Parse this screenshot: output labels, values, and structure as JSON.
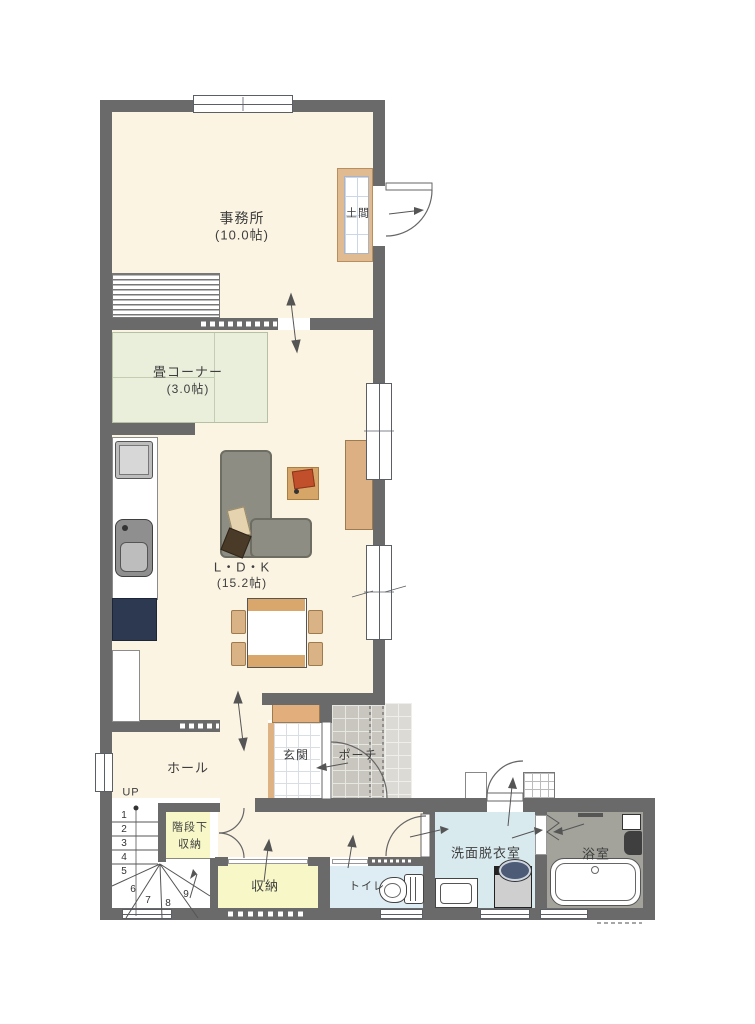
{
  "plan": {
    "title": "1F floor plan",
    "rooms": {
      "office": {
        "name": "事務所",
        "size": "(10.0帖)"
      },
      "doma": {
        "name": "土間"
      },
      "tatami": {
        "name": "畳コーナー",
        "size": "(3.0帖)"
      },
      "ldk": {
        "name": "L・D・K",
        "size": "(15.2帖)"
      },
      "hall": {
        "name": "ホール"
      },
      "genkan": {
        "name": "玄関"
      },
      "porch": {
        "name": "ポーチ"
      },
      "under_stairs_storage": {
        "name_line1": "階段下",
        "name_line2": "収納"
      },
      "storage": {
        "name": "収納"
      },
      "toilet": {
        "name": "トイレ"
      },
      "washroom": {
        "name": "洗面脱衣室"
      },
      "bathroom": {
        "name": "浴室"
      }
    },
    "stairs": {
      "up_label": "UP",
      "steps": [
        "1",
        "2",
        "3",
        "4",
        "5",
        "6",
        "7",
        "8",
        "9"
      ]
    },
    "palette": {
      "wall": "#6a6a6a",
      "floor_cream": "#fbf4e3",
      "tatami_green": "#e9efdb",
      "closet_yellow": "#f7f7c8",
      "washroom_blue": "#d9eaef",
      "toilet_blue": "#deedf3",
      "bath_gray": "#a3a39c",
      "porch_gray": "#c9c6bf",
      "wood_tan": "#d9a76b",
      "cushion_red": "#c14f2c",
      "fridge_navy": "#2d3950",
      "sofa_gray": "#8d8d83",
      "line": "#555555"
    }
  }
}
